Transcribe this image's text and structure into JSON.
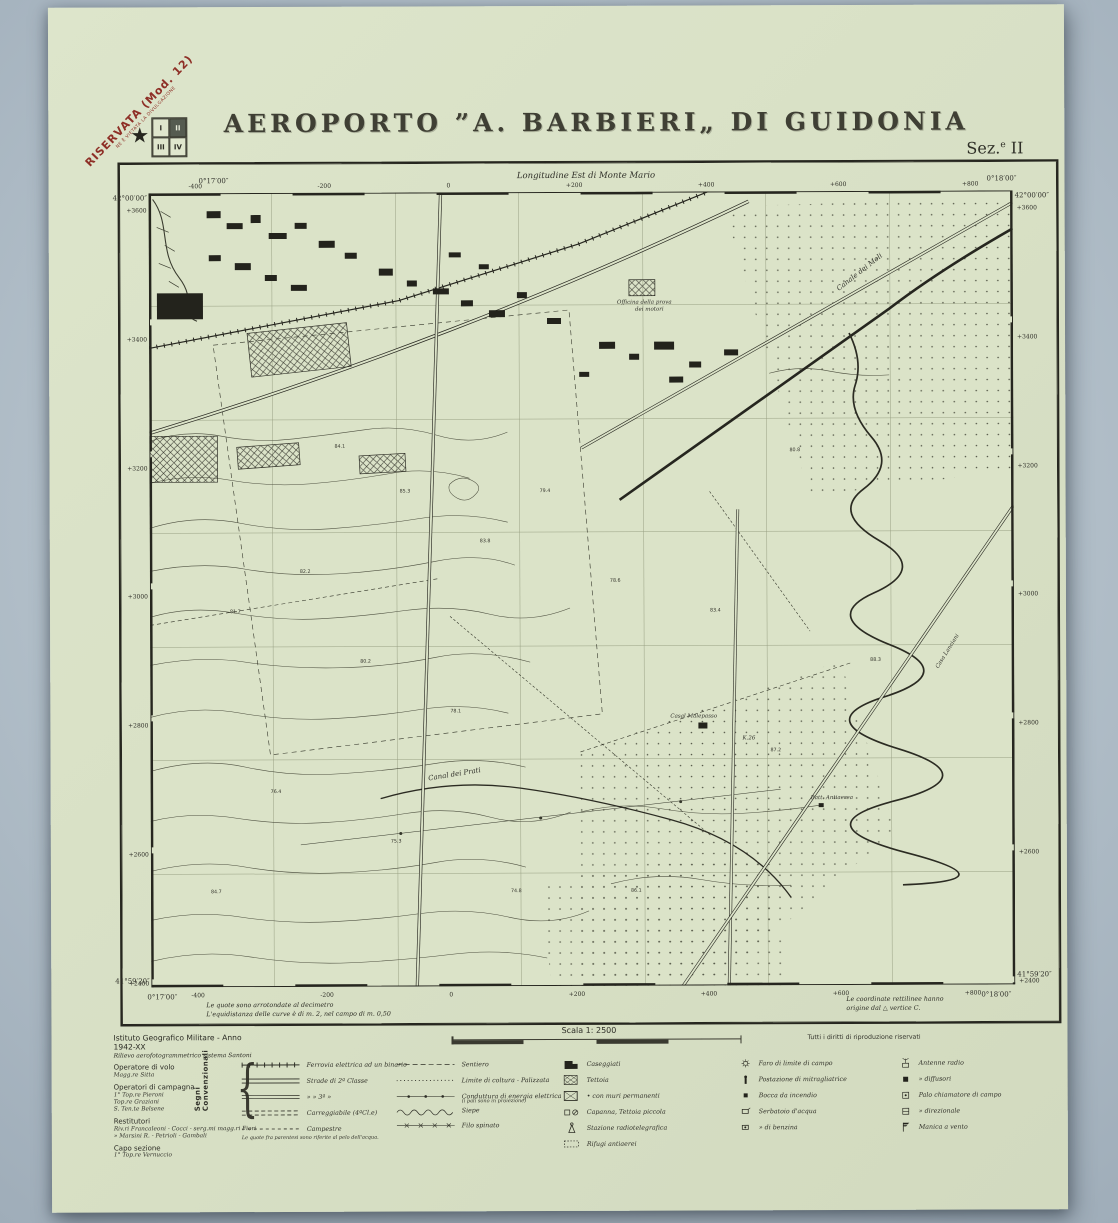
{
  "page": {
    "bg": "#b2bfc9",
    "paper": "#d8e0c5",
    "ink": "#2e2e26",
    "stamp_red": "#8e2f26"
  },
  "stamp": {
    "line1": "RISERVATA (Mod. 12)",
    "line2": "NE È VIETATA LA DIVULGAZIONE",
    "star": "★"
  },
  "quadrant": {
    "q1": "I",
    "q2": "II",
    "q3": "III",
    "q4": "IV"
  },
  "header": {
    "title": "AEROPORTO ”A. BARBIERI„ DI GUIDONIA",
    "section_pre": "Sez.",
    "section_sup": "e",
    "section_num": "II",
    "subtitle": "Longitudine Est di Monte Mario"
  },
  "corners": {
    "tl_lon": "0°17′00″",
    "tl_lat": "42°00′00″",
    "tr_lon": "0°18′00″",
    "tr_lat": "42°00′00″",
    "bl_lat": "41°59′20″",
    "bl_lon": "0°17′00″",
    "br_lat": "41°59′20″",
    "br_lon": "0°18′00″"
  },
  "grid": {
    "top": [
      "-400",
      "-200",
      "0",
      "+200",
      "+400",
      "+600",
      "+800"
    ],
    "bottom": [
      "-400",
      "-200",
      "0",
      "+200",
      "+400",
      "+600",
      "+800"
    ],
    "left": [
      "+3600",
      "+3400",
      "+3200",
      "+3000",
      "+2800",
      "+2600",
      "+2400"
    ],
    "right": [
      "+3600",
      "+3400",
      "+3200",
      "+3000",
      "+2800",
      "+2600",
      "+2400"
    ]
  },
  "map": {
    "labels": {
      "officina1": "Officina della prova",
      "officina2": "dei motori",
      "canale_moli": "Canale dei Moli",
      "casal": "Casal Malepasso",
      "canal_prati": "Canal dei Prati",
      "casa_lanciani": "Casa Lanciani",
      "km": "K.26",
      "batteria": "Batt. Antiaerea"
    },
    "spots": [
      "84.1",
      "85.3",
      "83.8",
      "82.2",
      "81.7",
      "80.2",
      "79.4",
      "78.6",
      "78.1",
      "76.4",
      "75.3",
      "74.8",
      "84.7",
      "86.1",
      "83.4",
      "80.8",
      "88.3",
      "87.2"
    ]
  },
  "notes": {
    "left1": "Le quote sono arrotondate al decimetro",
    "left2": "L'equidistanza delle curve è di m. 2, nel campo di m. 0,50",
    "right1": "Le coordinate rettilinee hanno",
    "right2": "origine dal △ vertice C.",
    "copyright": "Tutti i diritti di riproduzione riservati"
  },
  "scale": {
    "label": "Scala 1: 2500"
  },
  "credits": {
    "line1": "Istituto Geografico Militare - Anno 1942-XX",
    "line2": "Rilievo aerofotogrammetrico sistema Santoni",
    "h1": "Operatore di volo",
    "p1": "Magg.re Sitta",
    "h2": "Operatori di campagna",
    "p2": "1° Top.re Pieroni",
    "p3": "Top.re Graziani",
    "p4": "S. Ten.te Belsene",
    "h3": "Restitutori",
    "p5": "Riv.ri Francaleoni - Cocci - serg.mi magg.ri Fiori",
    "p6": "»  Marsini R. - Petrioli - Gambali",
    "h4": "Capo sezione",
    "p7": "1° Top.re Vernuccio"
  },
  "legend": {
    "heading": "Segni Convenzionali",
    "colA": [
      "Ferrovia elettrica ad un binario",
      "Strade  di  2ª  Classe",
      "»      »     3ª      »",
      "Carreggiabile   (4ªCl.e)",
      "Campestre"
    ],
    "colA_note": "Le quote fra parentesi sono riferite al pelo dell'acqua.",
    "colB": [
      "Sentiero",
      "Limite di coltura - Palizzata",
      "Conduttura di energia elettrica",
      "Siepe",
      "Filo spinato"
    ],
    "colB_sub": "(i pali sono in proiezione)",
    "colC": [
      "Caseggiati",
      "Tettoia",
      "•  con muri permanenti",
      "Capanna,  Tettoia piccola",
      "Stazione radiotelegrafica",
      "Rifugi  antiaerei"
    ],
    "colD": [
      "Faro di limite di campo",
      "Postazione di mitragliatrice",
      "Bocca da incendio",
      "Serbatoio d'acqua",
      "»  di benzina"
    ],
    "colE": [
      "Antenne radio",
      "»  diffusori",
      "Palo chiamatore di campo",
      "»  direzionale",
      "Manica a vento"
    ]
  }
}
